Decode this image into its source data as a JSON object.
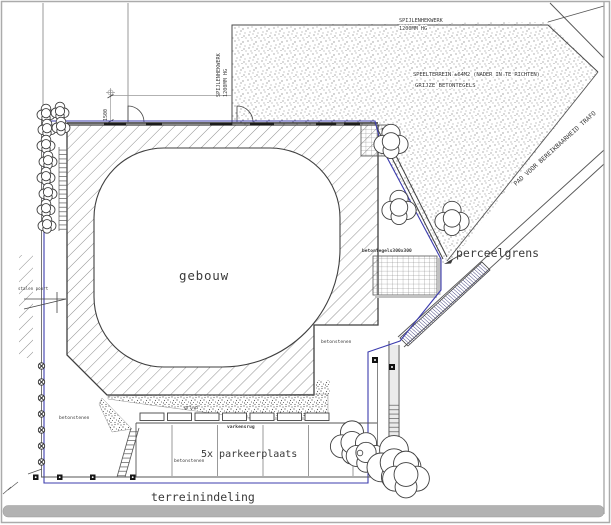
{
  "drawing": {
    "type": "architectural site plan",
    "labels": {
      "title": "terreinindeling",
      "building": "gebouw",
      "parking": "5x parkeerplaats",
      "parcel_boundary": "perceelgrens",
      "tiles": "betontegels300x300",
      "paving_a": "betonstenen",
      "paving_b": "betonstenen",
      "paving_c": "betonstenen",
      "gravel": "grind",
      "curb": "varkensrug",
      "gate": "stalen poort",
      "dim": "1500",
      "fence_top_1": "SPIJLENHEKWERK",
      "fence_top_2": "1200MM HG",
      "fence_left_1": "SPIJLENHEKWERK",
      "fence_left_2": "1200MM HG",
      "playground_1": "SPEELTERREIN ±64M2 (NADER IN TE RICHTEN)",
      "playground_2": "GRIJZE BETONTEGELS",
      "trafo_path": "PAD VOOR BEREIKBAARHEID TRAFO"
    },
    "colors": {
      "line_dark": "#3f3f3f",
      "line_gray": "#8f8f8f",
      "boundary_blue": "#3c3cae",
      "hatch": "#6a6a6a",
      "stipple": "#7b7b7b",
      "frame": "#ababab",
      "bottom_bar": "#b2b2b2",
      "text": "#3a3a3a"
    }
  }
}
